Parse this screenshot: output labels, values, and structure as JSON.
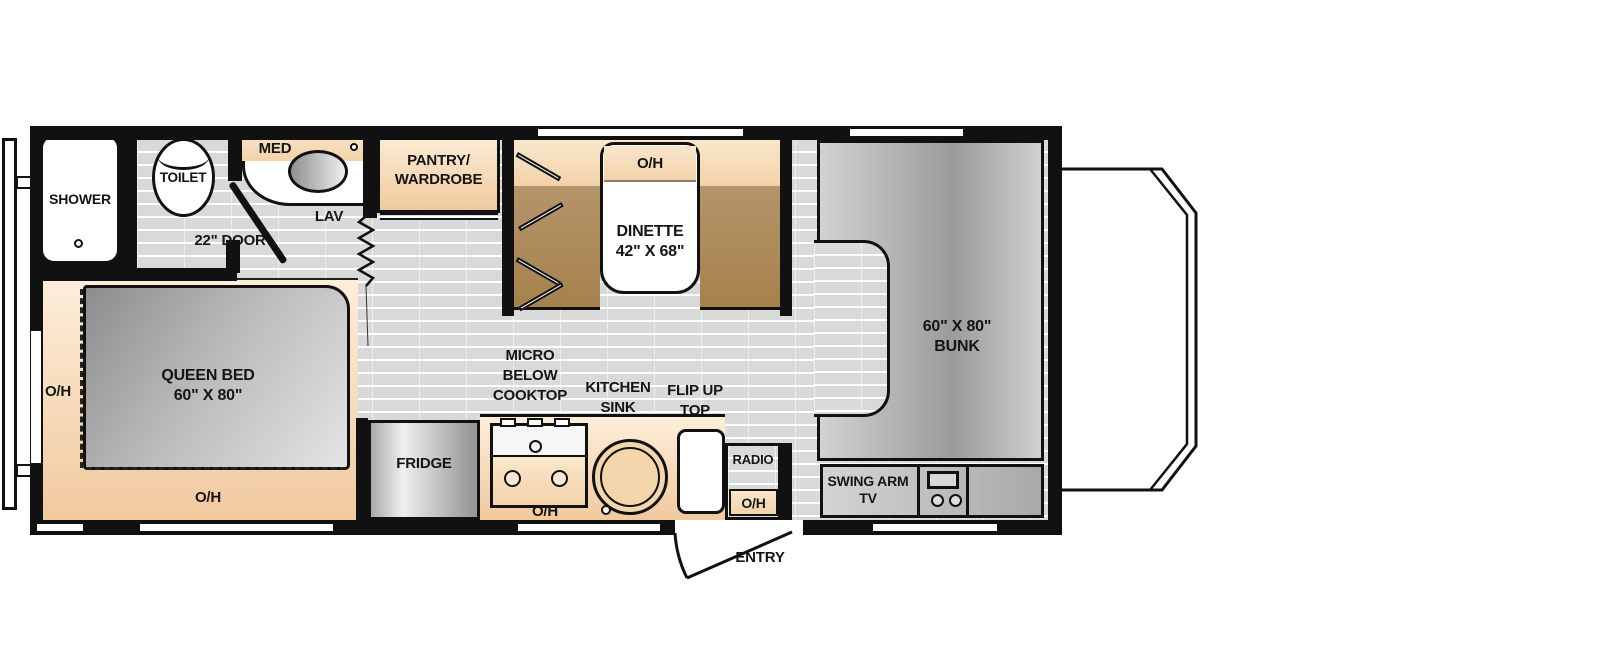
{
  "plan": {
    "type": "rv-motorhome-floorplan",
    "colors": {
      "wall": "#111111",
      "floor": "#d9d9d9",
      "cabinet_tan": "#f2d0a6",
      "bench_brown": "#ab8756",
      "furniture_gray": "#b5b5b5",
      "fixture_white": "#ffffff"
    },
    "labels": {
      "shower": "SHOWER",
      "toilet": "TOILET",
      "med": "MED",
      "lav": "LAV",
      "door_22": "22\" DOOR",
      "pantry": "PANTRY/\nWARDROBE",
      "oh": "O/H",
      "dinette": "DINETTE\n42\" X 68\"",
      "queen_bed": "QUEEN BED\n60\" X 80\"",
      "bunk": "60\" X 80\"\nBUNK",
      "fridge": "FRIDGE",
      "micro": "MICRO\nBELOW\nCOOKTOP",
      "kitchen_sink": "KITCHEN\nSINK",
      "flip_up_top": "FLIP UP\nTOP",
      "radio": "RADIO",
      "swing_arm_tv": "SWING ARM\nTV",
      "entry": "ENTRY"
    }
  }
}
